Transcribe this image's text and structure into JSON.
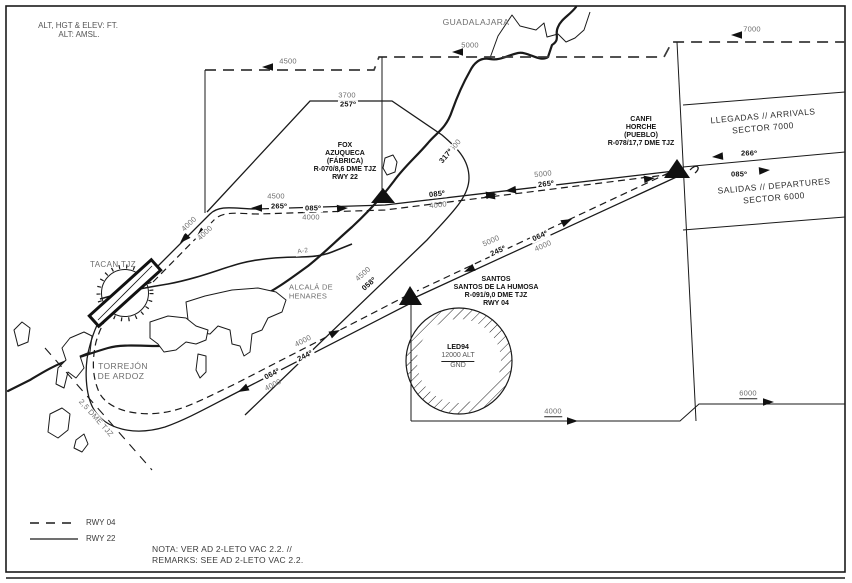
{
  "meta": {
    "units_line1": "ALT, HGT & ELEV: FT.",
    "units_line2": "ALT: AMSL."
  },
  "colors": {
    "line": "#1a1a1a",
    "muted_text": "#6e6e6e"
  },
  "cities": {
    "guadalajara": "GUADALAJARA",
    "alcala_1": "ALCALÁ DE",
    "alcala_2": "HENARES",
    "torrejon_1": "TORREJÓN",
    "torrejon_2": "DE ARDOZ",
    "road": "A-2"
  },
  "navaid": {
    "tacan": "TACAN TJZ",
    "dme_arc": "2,5 DME TJZ"
  },
  "waypoints": {
    "fox": [
      "FOX",
      "AZUQUECA",
      "(FÁBRICA)",
      "R-070/8,6 DME TJZ",
      "RWY 22"
    ],
    "canfi": [
      "CANFI",
      "HORCHE",
      "(PUEBLO)",
      "R-078/17,7 DME TJZ"
    ],
    "santos": [
      "SANTOS",
      "SANTOS DE LA HUMOSA",
      "R-091/9,0 DME TJZ",
      "RWY 04"
    ]
  },
  "restricted_area": {
    "name": "LED94",
    "upper_limit": "12000 ALT",
    "lower_limit": "GND"
  },
  "sectors": {
    "arrivals_1": "LLEGADAS // ARRIVALS",
    "arrivals_2": "SECTOR 7000",
    "departures_1": "SALIDAS // DEPARTURES",
    "departures_2": "SECTOR 6000"
  },
  "labels": {
    "alt4500_nw": "4500",
    "alt5000_n": "5000",
    "alt7000_ne": "7000",
    "alt3700": "3700",
    "brg257": "257º",
    "alt4500_317": "4500",
    "brg317": "317º",
    "alt4500_w": "4500",
    "brg265_w": "265º",
    "brg085_w": "085º",
    "alt4000_w": "4000",
    "alt4000_d1": "4000",
    "alt4000_d2": "4000",
    "brg085_e": "085º",
    "alt4000_e": "4000",
    "alt5000_mid": "5000",
    "brg265_mid": "265º",
    "brg266": "266º",
    "brg085_canfi": "085º",
    "alt5000_s": "5000",
    "brg245": "245º",
    "brg064_ne": "064º",
    "alt4000_ne": "4000",
    "alt4500_058": "4500",
    "brg058": "058º",
    "alt4000_sw1": "4000",
    "brg244": "244º",
    "brg064_sw": "064º",
    "alt4000_sw2": "4000",
    "alt4000_bottom": "4000",
    "alt6000": "6000"
  },
  "legend": {
    "dashed": "RWY 04",
    "solid": "RWY 22"
  },
  "note": {
    "line1": "NOTA: VER AD 2-LETO VAC 2.2. //",
    "line2": "REMARKS: SEE AD 2-LETO VAC 2.2."
  }
}
